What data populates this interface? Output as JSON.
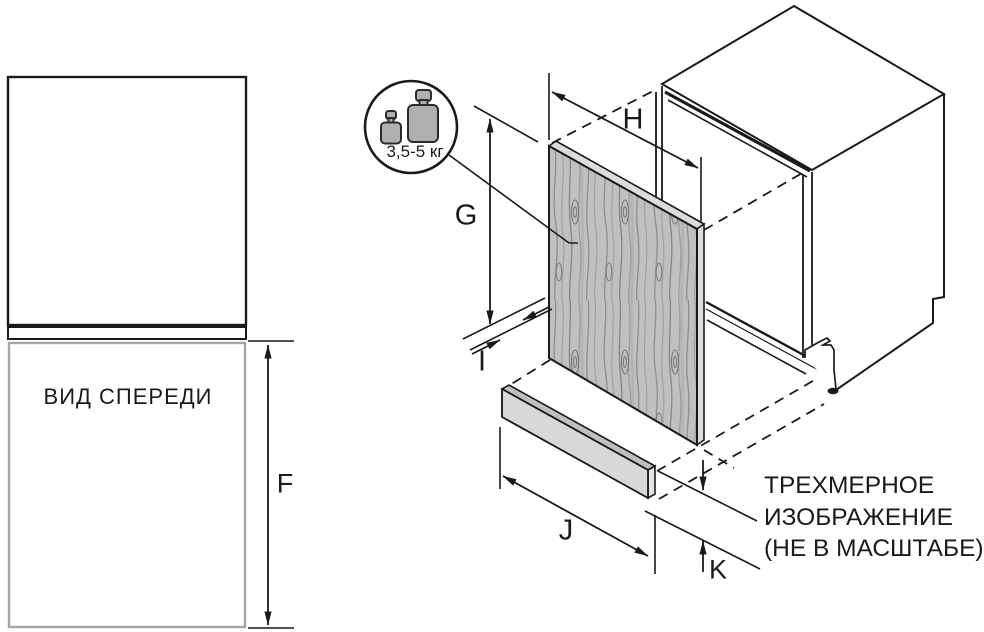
{
  "front_view": {
    "caption": "ВИД СПЕРЕДИ"
  },
  "weight_badge": {
    "label": "3,5-5 кг"
  },
  "dimension_labels": {
    "F": "F",
    "G": "G",
    "H": "H",
    "I": "I",
    "J": "J",
    "K": "K"
  },
  "note": {
    "lines": [
      "ТРЕХМЕРНОЕ",
      "ИЗОБРАЖЕНИЕ",
      "(НЕ В МАСШТАБЕ)"
    ]
  },
  "colors": {
    "line": "#1a1a1a",
    "front_view_outline_gray": "#a6a6a6",
    "wood_base": "#c0c0c0",
    "wood_grain_dark": "#878787",
    "panel_edge": "#dcdcdc",
    "plinth_front": "#d8d8d8",
    "plinth_top": "#bfbfbf",
    "weight_fill": "#b0b0b0",
    "background": "#ffffff"
  }
}
